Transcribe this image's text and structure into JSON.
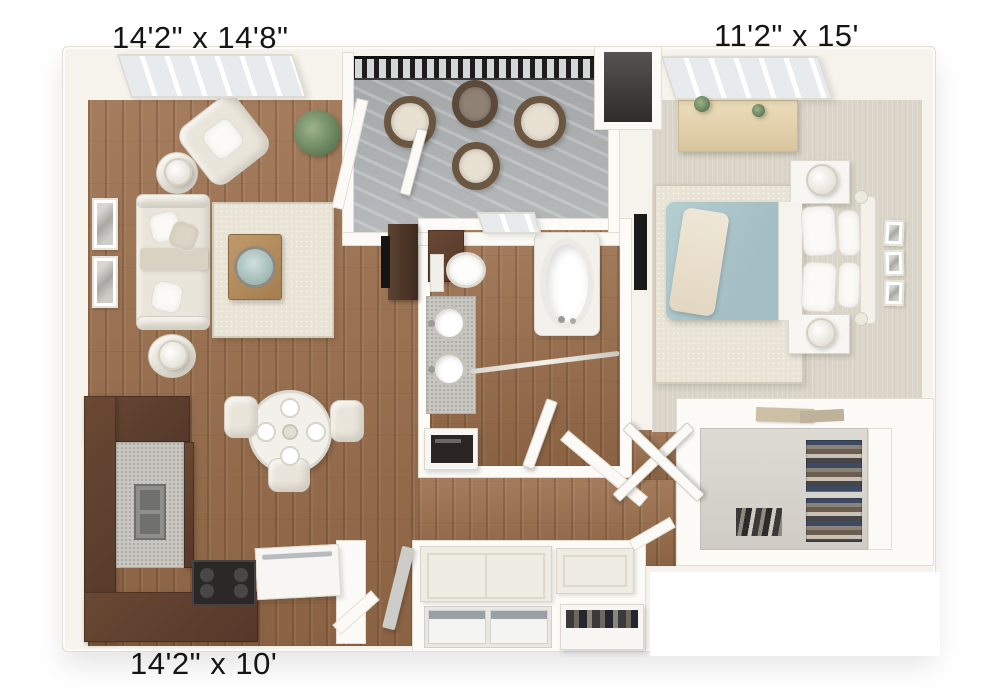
{
  "labels": {
    "living_room": "14'2\" x 14'8\"",
    "bedroom": "11'2\" x 15'",
    "kitchen": "14'2\" x 10'"
  },
  "colors": {
    "background": "#ffffff",
    "wall": "#f6f3ed",
    "wall_line": "#e2ded4",
    "wood_floor": "#9a6e4b",
    "carpet": "#d9d4c7",
    "rug": "#e8e3d4",
    "balcony_floor": "#b2b5b7",
    "railing": "#1d1d1d",
    "cabinet": "#54382a",
    "countertop": "#c9c7c1",
    "bed": "#b6cdd1",
    "upholstery": "#eae5da",
    "appliance_dark": "#2b2927",
    "label_text": "#151515"
  }
}
